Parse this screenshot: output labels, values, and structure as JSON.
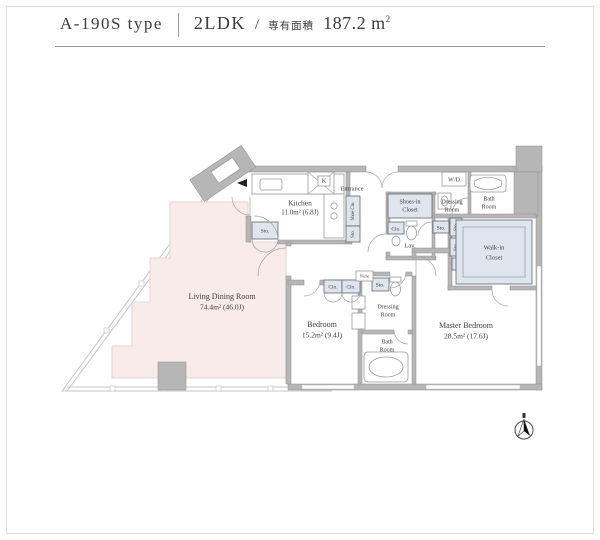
{
  "header": {
    "type_name": "A-190S type",
    "layout": "2LDK",
    "separator": "/",
    "area_label": "専有面積",
    "area_value": "187.2 m",
    "area_sup": "2"
  },
  "rooms": {
    "living": {
      "name": "Living Dining Room",
      "size": "74.4m²  (46.0J)"
    },
    "kitchen": {
      "name": "Kitchen",
      "size": "11.0m²  (6.8J)"
    },
    "bedroom": {
      "name": "Bedroom",
      "size": "15.2m²  (9.4J)"
    },
    "master": {
      "name": "Master Bedroom",
      "size": "28.5m²  (17.6J)"
    },
    "entrance": {
      "name": "Entrance"
    },
    "lav": {
      "name": "Lav."
    },
    "wd": {
      "name": "W/D"
    },
    "shoes_in_closet": {
      "line1": "Shoes-in",
      "line2": "Closet"
    },
    "dressing_upper": {
      "line1": "Dressing",
      "line2": "Room"
    },
    "dressing_lower": {
      "line1": "Dressing",
      "line2": "Room"
    },
    "bath_upper": {
      "line1": "Bath",
      "line2": "Room"
    },
    "bath_lower": {
      "line1": "Bath",
      "line2": "Room"
    },
    "walk_in_closet": {
      "line1": "Walk-in",
      "line2": "Closet"
    }
  },
  "labels": {
    "sto": "Sto.",
    "clo": "Clo.",
    "shoe_closet": "Shoe Clo.",
    "niche": "Niche",
    "kitchen_duct": "K"
  },
  "colors": {
    "ldk_fill": "#f8ebe9",
    "closet_fill": "#dfe5ee",
    "wall_fill": "#b6b6b6"
  }
}
